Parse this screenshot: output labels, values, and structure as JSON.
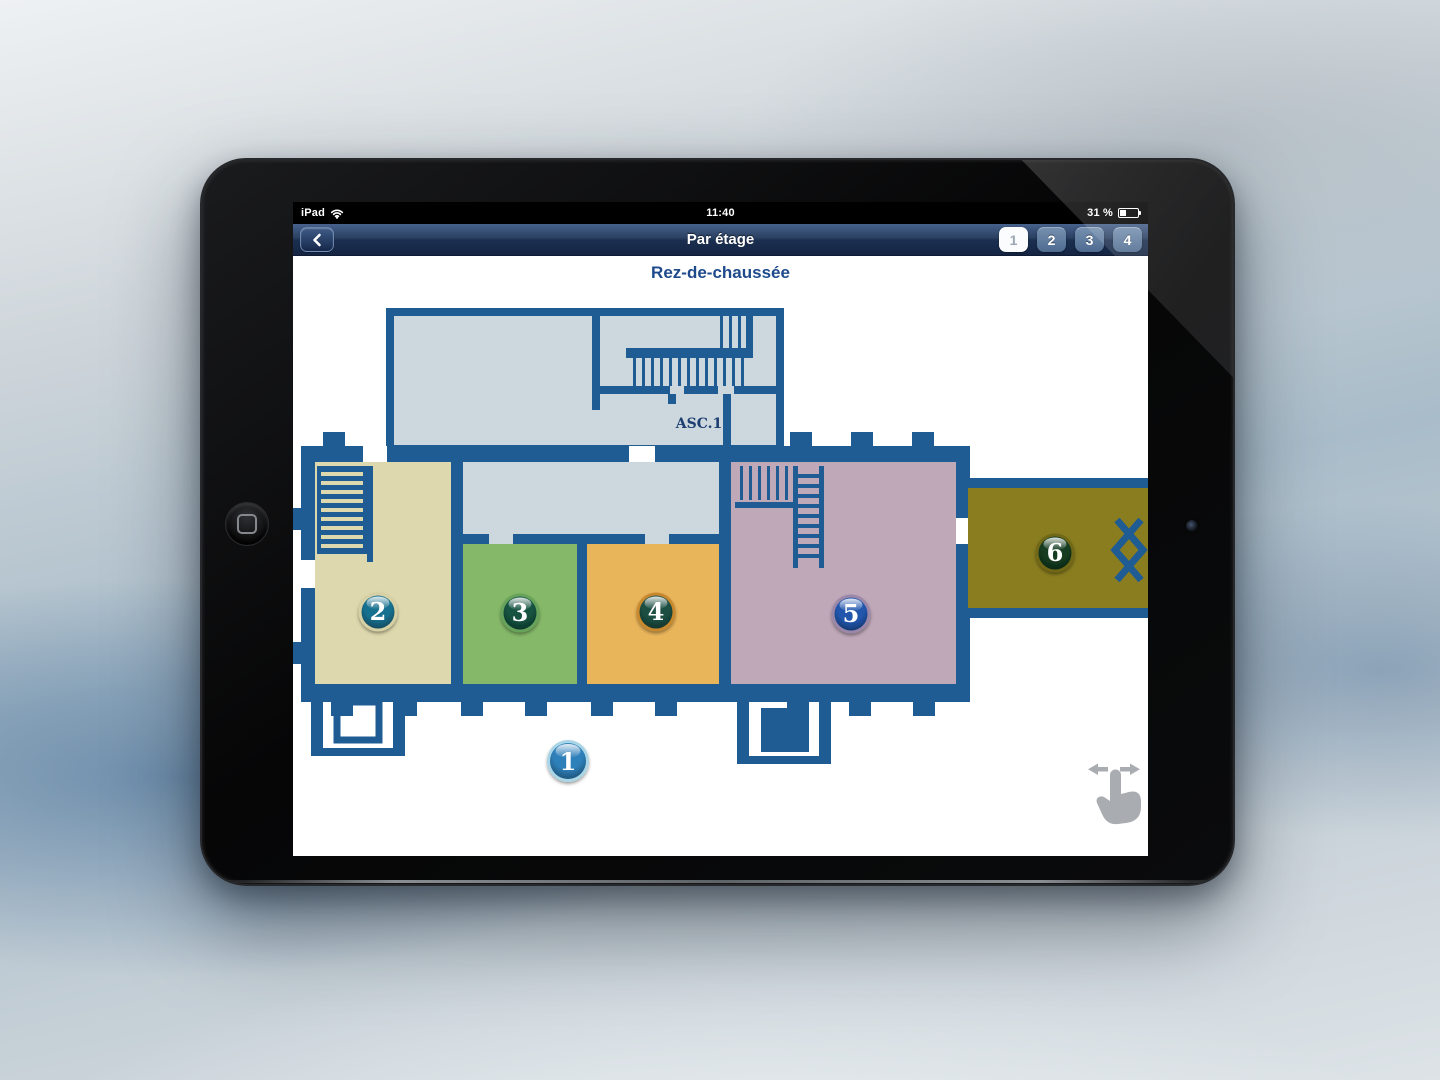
{
  "status_bar": {
    "carrier": "iPad",
    "time": "11:40",
    "battery": "31 %"
  },
  "nav_bar": {
    "title": "Par étage",
    "pages": [
      "1",
      "2",
      "3",
      "4"
    ],
    "active_page": "1"
  },
  "plan": {
    "title": "Rez-de-chaussée",
    "elevator_label": "ASC.1",
    "colors": {
      "wall": "#1f5c94",
      "room_light": "#ccd8dd",
      "room_2": "#ddd8ad",
      "room_3": "#85b868",
      "room_4": "#e9b55b",
      "room_5": "#bfa8b8",
      "room_6": "#8a7d20"
    },
    "markers": [
      {
        "label": "1",
        "fill": "#2f80ba",
        "ring": "#a9d5e6"
      },
      {
        "label": "2",
        "fill": "#19708f",
        "ring": "#d6d0a4"
      },
      {
        "label": "3",
        "fill": "#14523f",
        "ring": "#67a35b"
      },
      {
        "label": "4",
        "fill": "#1c4f43",
        "ring": "#c8892e"
      },
      {
        "label": "5",
        "fill": "#2156ad",
        "ring": "#9b88a9"
      },
      {
        "label": "6",
        "fill": "#143c20",
        "ring": "#6f6716"
      }
    ],
    "icons": {
      "gesture_hint": "swipe-horizontal",
      "back": "chevron-left",
      "wifi": "wifi",
      "battery": "battery"
    }
  }
}
